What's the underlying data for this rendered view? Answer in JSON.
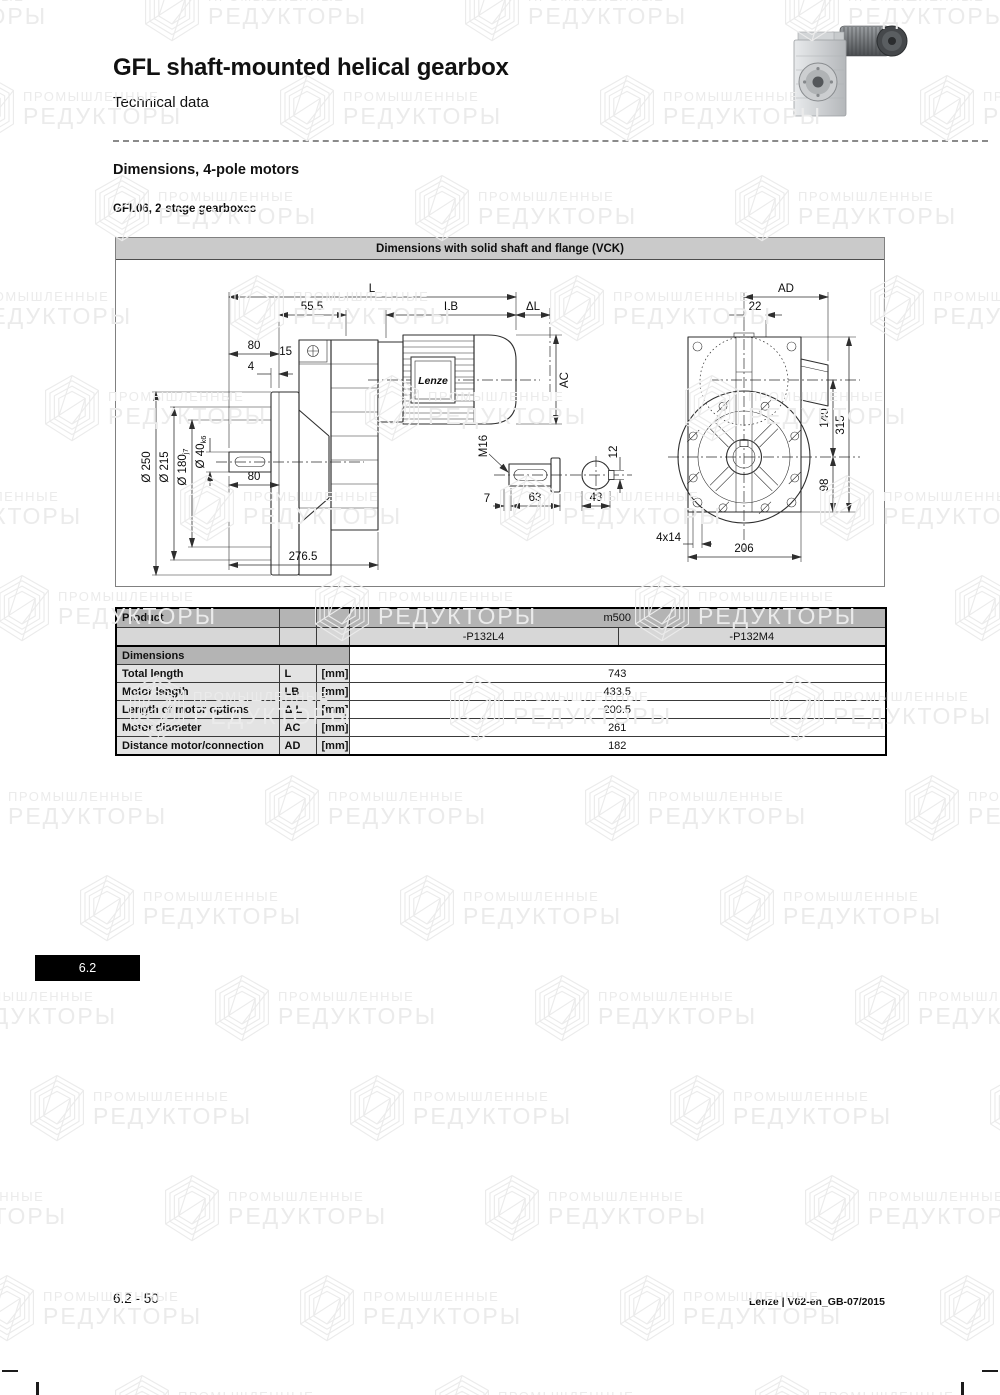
{
  "page": {
    "header": {
      "title": "GFL shaft-mounted helical gearbox",
      "subtitle": "Technical data"
    },
    "section": {
      "heading": "Dimensions, 4-pole motors",
      "subheading": "GFL06, 2-stage gearboxes"
    },
    "side_tab": "6.2",
    "footer": {
      "page_ref": "6.2 - 50",
      "doc_ref": "Lenze | V02-en_GB-07/2015"
    },
    "watermark": {
      "line1": "ПРОМЫШЛЕННЫЕ",
      "line2": "РЕДУКТОРЫ"
    }
  },
  "drawing": {
    "title": "Dimensions with solid shaft and flange (VCK)",
    "motor_brand": "Lenze",
    "dims": {
      "L": "L",
      "LB": "LB",
      "delta_L": "ΔL",
      "AC": "AC",
      "AD": "AD",
      "len_55_5": "55.5",
      "len_80_top": "80",
      "len_15": "15",
      "len_4": "4",
      "dia_250": "Ø 250",
      "dia_215": "Ø 215",
      "dia_180": "Ø 180",
      "dia_180_tol": "j7",
      "dia_40": "Ø 40",
      "dia_40_tol": "k6",
      "len_80_shaft": "80",
      "len_276_5": "276.5",
      "thread_m16": "M16",
      "len_12": "12",
      "len_7": "7",
      "len_63": "63",
      "len_43": "43",
      "len_22": "22",
      "len_140": "140",
      "len_315": "315",
      "len_98": "98",
      "holes_4x14": "4x14",
      "len_206": "206"
    }
  },
  "table": {
    "product_label": "Product",
    "product_value": "m500",
    "variants": [
      "-P132L4",
      "-P132M4"
    ],
    "section_label": "Dimensions",
    "rows": [
      {
        "label": "Total length",
        "symbol": "L",
        "unit": "[mm]",
        "value": "743"
      },
      {
        "label": "Motor length",
        "symbol": "LB",
        "unit": "[mm]",
        "value": "433.5"
      },
      {
        "label": "Length of motor options",
        "symbol": "Δ L",
        "unit": "[mm]",
        "value": "200.5"
      },
      {
        "label": "Motor diameter",
        "symbol": "AC",
        "unit": "[mm]",
        "value": "261"
      },
      {
        "label": "Distance motor/connection",
        "symbol": "AD",
        "unit": "[mm]",
        "value": "182"
      }
    ]
  },
  "colors": {
    "table_header_bg": "#b4b4b4",
    "table_row_bg": "#d7d7d7",
    "table_label_bg": "#e3e3e3",
    "titlebar_bg": "#cacaca",
    "tab_bg": "#000000",
    "tab_fg": "#ffffff",
    "watermark": "#ebebeb",
    "line_color": "#2e2e2e"
  }
}
